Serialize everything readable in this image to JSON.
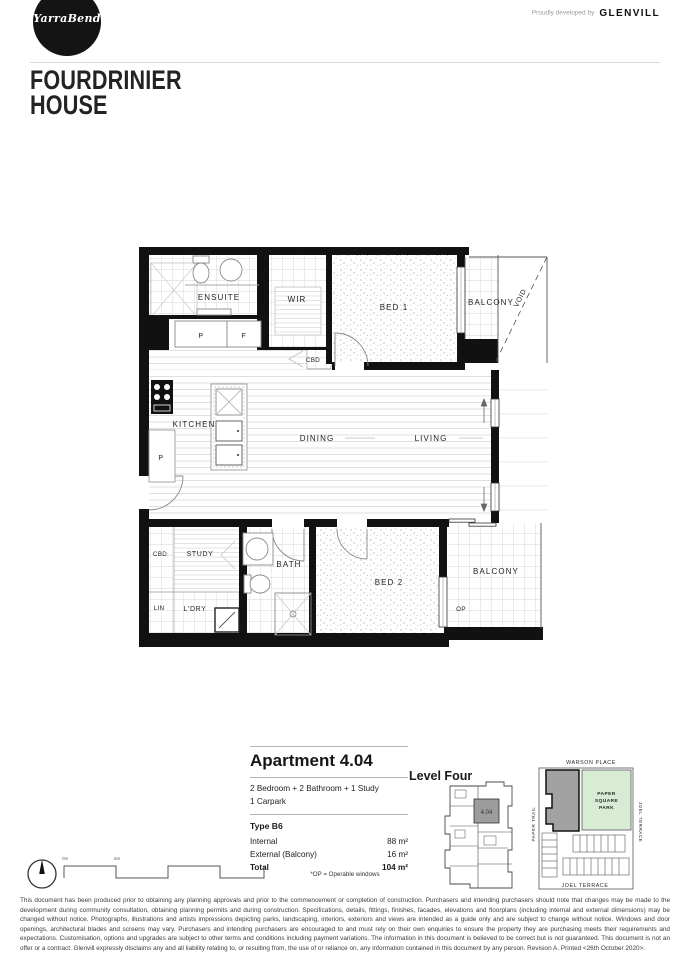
{
  "header": {
    "logo_text": "YarraBend",
    "developed_by_prefix": "Proudly developed by",
    "developer_name": "GLENVILL",
    "title_line1": "FOURDRINIER",
    "title_line2": "HOUSE"
  },
  "plan": {
    "ensuite": "ENSUITE",
    "wir": "WIR",
    "bed1": "BED 1",
    "balcony_top": "BALCONY",
    "void": "VOID",
    "cbd_hall": "CBD",
    "pantry_upper": "P",
    "fridge": "F",
    "kitchen": "KITCHEN",
    "pantry_lower": "P",
    "dining": "DINING",
    "living": "LIVING",
    "cbd_study": "CBD",
    "study": "STUDY",
    "lin": "LIN",
    "laundry": "L'DRY",
    "bath": "BATH",
    "bed2": "BED 2",
    "balcony_bottom": "BALCONY",
    "op": "OP"
  },
  "info": {
    "apartment_title": "Apartment 4.04",
    "configuration": "2 Bedroom + 2 Bathroom + 1 Study",
    "carpark": "1 Carpark",
    "type_label": "Type B6",
    "areas": [
      {
        "label": "Internal",
        "value": "88 m²"
      },
      {
        "label": "External (Balcony)",
        "value": "16 m²"
      },
      {
        "label": "Total",
        "value": "104 m²"
      }
    ],
    "op_note": "*OP = Operable windows"
  },
  "level": {
    "title": "Level Four",
    "unit": "4.04"
  },
  "map": {
    "street_top": "WARSON PLACE",
    "street_left": "PAPER TRAIL",
    "street_right": "JOEL TERRACE",
    "street_bottom": "JOEL TERRACE",
    "park_line1": "PAPER",
    "park_line2": "SQUARE",
    "park_line3": "PARK",
    "park_color": "#d8ecd3",
    "building_color": "#a2a2a2"
  },
  "scalebar": {
    "label_start": "0m",
    "label_mid": "5m"
  },
  "disclaimer": "This document has been produced prior to obtaining any planning approvals and prior to the commencement or completion of construction. Purchasers and intending purchasers should note that changes may be made to the development during community consultation, obtaining planning permits and during construction. Specifications, details, fittings, finishes, facades, elevations and floorplans (including internal and external dimensions) may be changed without notice. Photographs, illustrations and artists impressions depicting parks, landscaping, interiors, exteriors and views are intended as a guide only and are subject to change without notice. Windows and door openings, architectural blades and screens may vary. Purchasers and intending purchasers are encouraged to and must rely on their own enquiries to ensure the property they are purchasing meets their requirements and expectations. Customisation, options and upgrades are subject to other terms and conditions including payment variations. The information in this document is believed to be correct but is not guaranteed. This document is not an offer or a contract. Glenvill expressly disclaims any and all liability relating to, or resulting from, the use of or reliance on, any information contained in this document by any person. Revision A. Printed <26th October 2020>."
}
